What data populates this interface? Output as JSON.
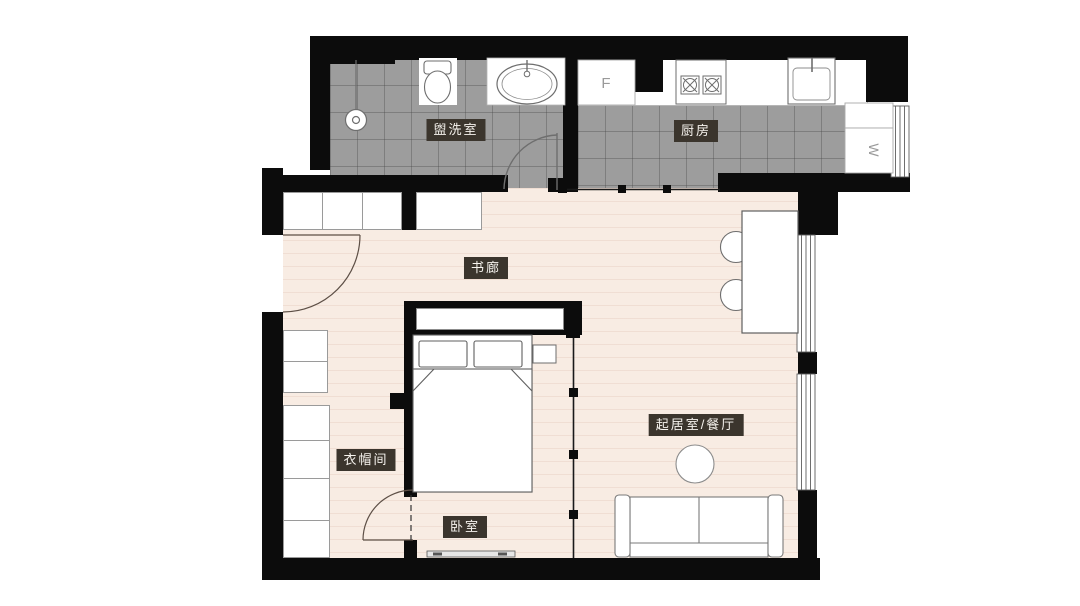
{
  "canvas": {
    "width": 1080,
    "height": 606,
    "background": "#ffffff"
  },
  "colors": {
    "wall": "#0c0c0c",
    "tile_floor": "#9d9d9d",
    "tile_grid_line": "#5e5e5e",
    "wood_floor": "#f8ece3",
    "wood_stripe": "#ecd8cb",
    "furniture_stroke": "#757575",
    "label_bg": "#3b352d",
    "label_text": "#f6f3ee"
  },
  "rooms": [
    {
      "id": "washroom",
      "label": "盥洗室"
    },
    {
      "id": "kitchen",
      "label": "厨房"
    },
    {
      "id": "book-gallery",
      "label": "书廊"
    },
    {
      "id": "living-dining",
      "label": "起居室/餐厅"
    },
    {
      "id": "cloakroom",
      "label": "衣帽间"
    },
    {
      "id": "bedroom",
      "label": "卧室"
    }
  ],
  "marks": {
    "fridge": "F",
    "washer": "W"
  }
}
